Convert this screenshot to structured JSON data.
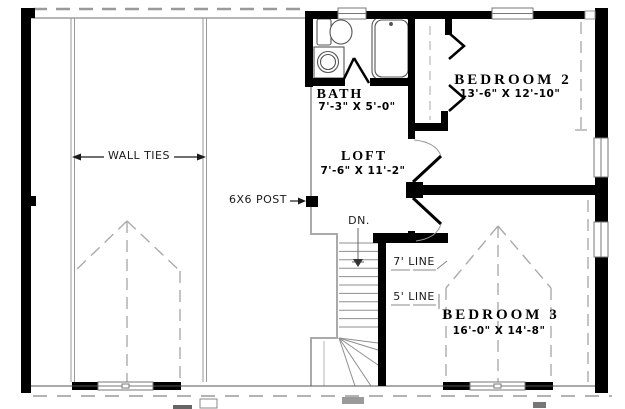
{
  "colors": {
    "wall": "#000000",
    "dashed_line": "#a8a8a8",
    "thin_line": "#888888"
  },
  "rooms": {
    "bath": {
      "name": "BATH",
      "dims": "7'-3\" X 5'-0\""
    },
    "loft": {
      "name": "LOFT",
      "dims": "7'-6\" X 11'-2\""
    },
    "bedroom2": {
      "name": "BEDROOM 2",
      "dims": "13'-6\" X 12'-10\""
    },
    "bedroom3": {
      "name": "BEDROOM 3",
      "dims": "16'-0\" X 14'-8\""
    }
  },
  "annotations": {
    "wall_ties": "WALL TIES",
    "post": "6X6 POST",
    "down": "DN.",
    "line_7": "7' LINE",
    "line_5": "5' LINE"
  }
}
